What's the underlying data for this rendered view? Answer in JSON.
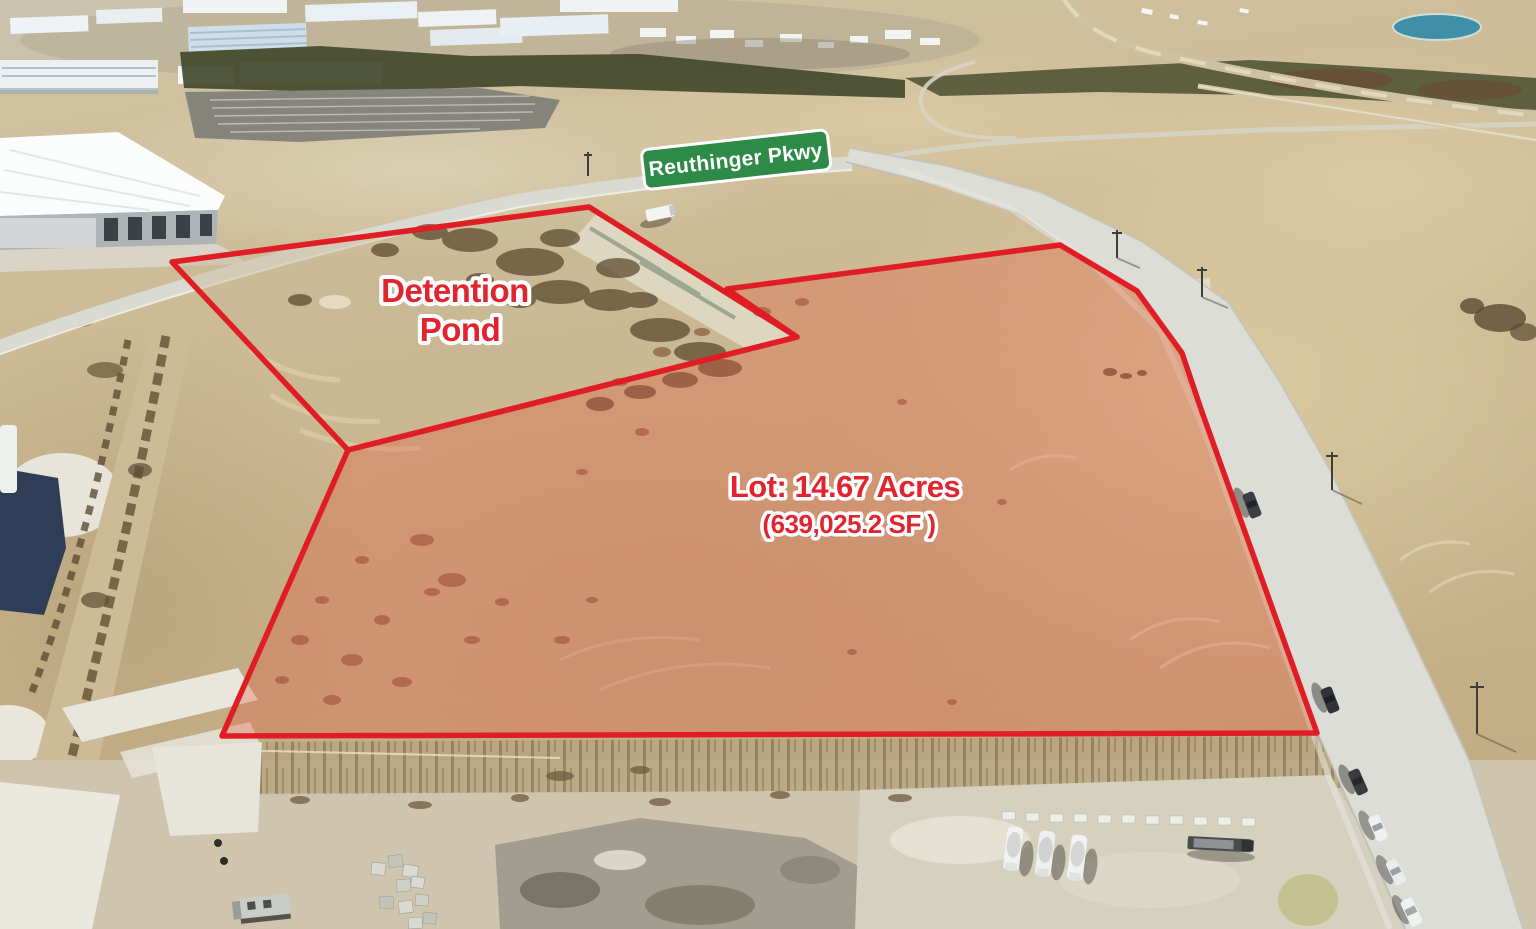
{
  "annotations": {
    "street_sign": {
      "label": "Reuthinger Pkwy"
    },
    "detention_pond": {
      "line1": "Detention",
      "line2": "Pond"
    },
    "lot": {
      "line1": "Lot: 14.67 Acres",
      "line2": "(639,025.2 SF )"
    }
  },
  "colors": {
    "boundary_red": "#e01d24",
    "lot_fill": "rgba(228,90,68,0.33)",
    "label_red": "#e2242f",
    "sign_green": "#2e8b47",
    "sign_text": "#ffffff"
  }
}
